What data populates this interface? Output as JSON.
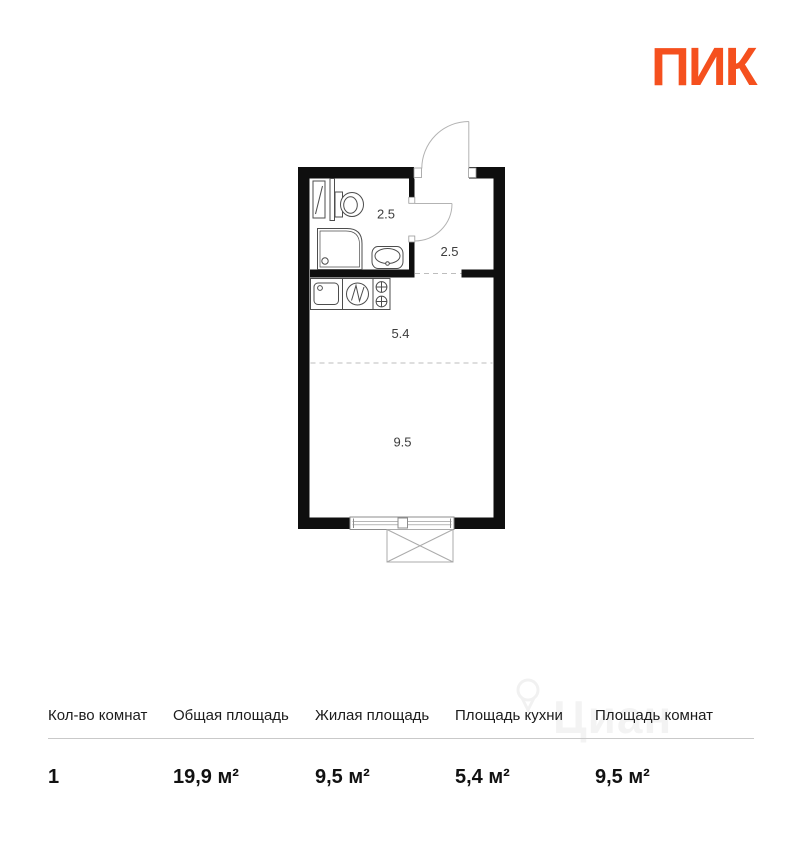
{
  "brand": {
    "logo_text": "ПИК",
    "logo_color": "#F5501E"
  },
  "floor_plan": {
    "wall_color": "#0f0f0f",
    "room_labels": [
      {
        "name": "bathroom",
        "area": "2.5"
      },
      {
        "name": "hallway",
        "area": "2.5"
      },
      {
        "name": "kitchen",
        "area": "5.4"
      },
      {
        "name": "living_room",
        "area": "9.5"
      }
    ]
  },
  "watermark": {
    "text": "Циан"
  },
  "summary_table": {
    "columns": [
      {
        "label": "Кол-во комнат",
        "value": "1"
      },
      {
        "label": "Общая площадь",
        "value": "19,9 м²"
      },
      {
        "label": "Жилая площадь",
        "value": "9,5 м²"
      },
      {
        "label": "Площадь кухни",
        "value": "5,4 м²"
      },
      {
        "label": "Площадь комнат",
        "value": "9,5 м²"
      }
    ]
  }
}
